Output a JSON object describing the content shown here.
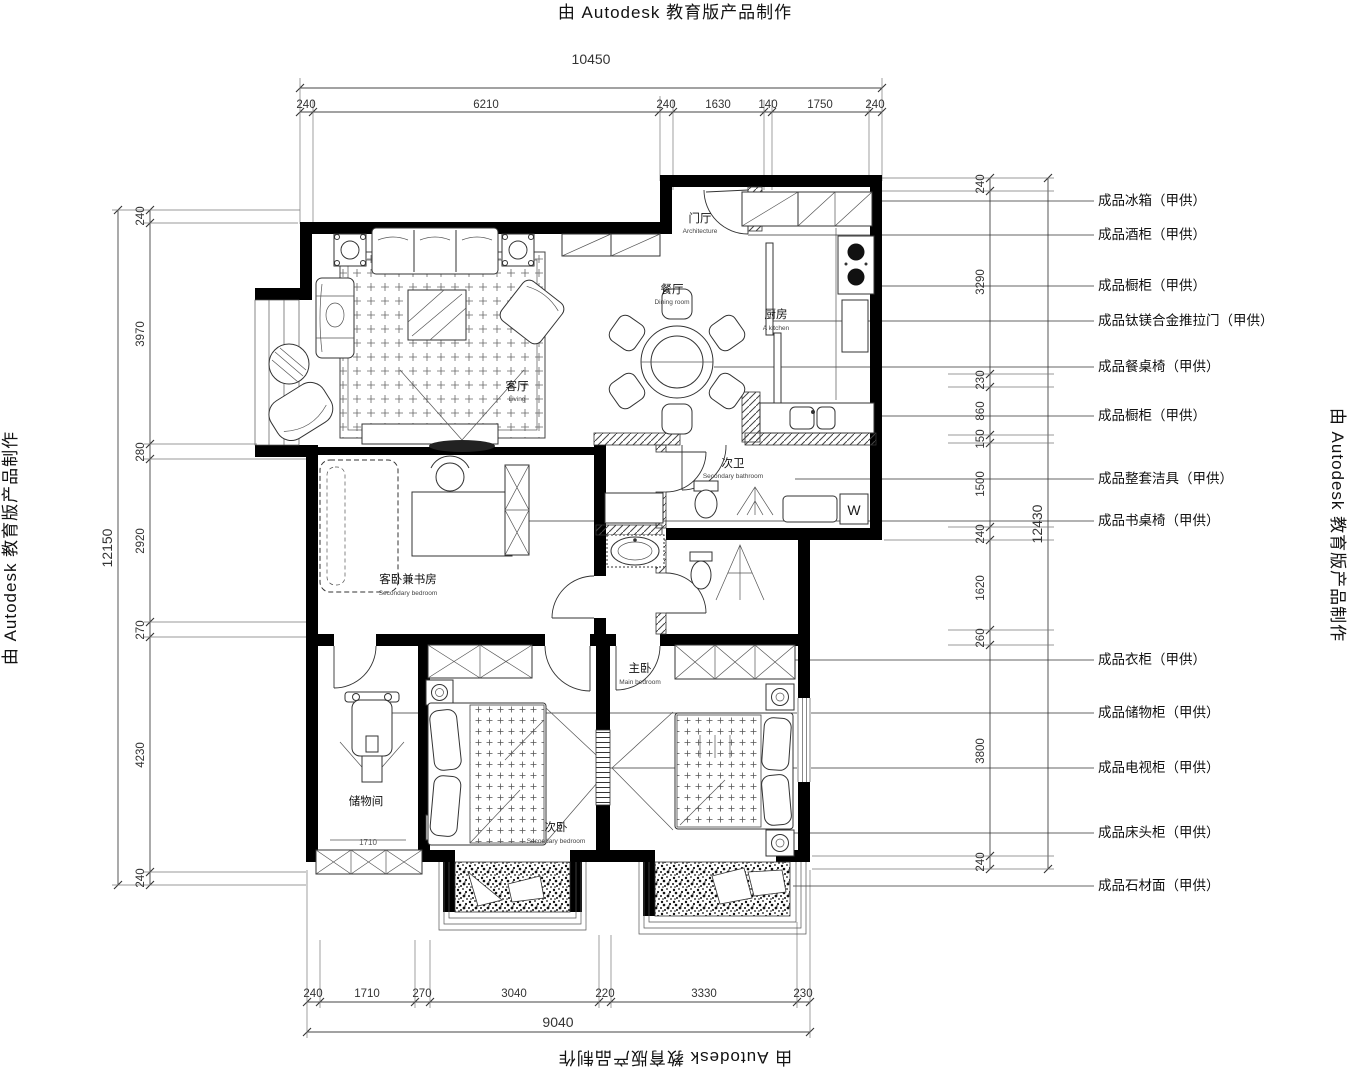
{
  "titles": {
    "text": "由 Autodesk 教育版产品制作"
  },
  "dimensions": {
    "top": {
      "overall": "10450",
      "segments": [
        "240",
        "6210",
        "240",
        "1630",
        "140",
        "1750",
        "240"
      ]
    },
    "left": {
      "overall": "12150",
      "segments": [
        "240",
        "3970",
        "280",
        "2920",
        "270",
        "4230",
        "240"
      ]
    },
    "right": {
      "overall": "12430",
      "segments": [
        "240",
        "3290",
        "230",
        "860",
        "150",
        "1500",
        "240",
        "1620",
        "260",
        "3800",
        "240"
      ]
    },
    "bottom": {
      "overall": "9040",
      "segments": [
        "240",
        "1710",
        "270",
        "3040",
        "220",
        "3330",
        "230"
      ]
    }
  },
  "callouts": [
    {
      "label": "成品冰箱（甲供）"
    },
    {
      "label": "成品酒柜（甲供）"
    },
    {
      "label": "成品橱柜（甲供）"
    },
    {
      "label": "成品钛镁合金推拉门（甲供）"
    },
    {
      "label": "成品餐桌椅（甲供）"
    },
    {
      "label": "成品橱柜（甲供）"
    },
    {
      "label": "成品整套洁具（甲供）"
    },
    {
      "label": "成品书桌椅（甲供）"
    },
    {
      "label": "成品衣柜（甲供）"
    },
    {
      "label": "成品储物柜（甲供）"
    },
    {
      "label": "成品电视柜（甲供）"
    },
    {
      "label": "成品床头柜（甲供）"
    },
    {
      "label": "成品石材面（甲供）"
    }
  ],
  "rooms": {
    "entry": {
      "name": "门厅",
      "en": "Architecture"
    },
    "dining": {
      "name": "餐厅",
      "en": "Dining room"
    },
    "kitchen": {
      "name": "厨房",
      "en": "A kitchen"
    },
    "living": {
      "name": "客厅",
      "en": "Living"
    },
    "bath2": {
      "name": "次卫",
      "en": "Secondary bathroom"
    },
    "study": {
      "name": "客卧兼书房",
      "en": "Secondary bedroom"
    },
    "storage": {
      "name": "储物间",
      "dim": "1710"
    },
    "bed2": {
      "name": "次卧",
      "en": "Secondary bedroom"
    },
    "master": {
      "name": "主卧",
      "en": "Main bedroom"
    }
  },
  "fixtures": {
    "washer": "W"
  }
}
